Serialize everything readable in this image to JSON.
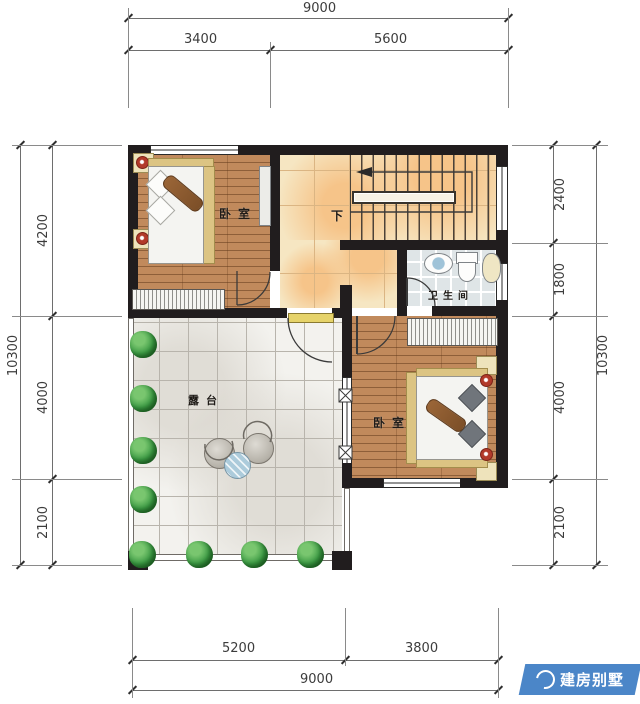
{
  "plan": {
    "rooms": {
      "bedroom1": "卧室",
      "bedroom2": "卧室",
      "bathroom": "卫生间",
      "terrace": "露台",
      "stairs_down": "下"
    },
    "dimensions": {
      "top": {
        "total": "9000",
        "a": "3400",
        "b": "5600"
      },
      "left": {
        "total": "10300",
        "a": "4200",
        "b": "4000",
        "c": "2100"
      },
      "right": {
        "a": "2400",
        "b": "1800",
        "c": "4000",
        "d": "2100",
        "total": "10300"
      },
      "bottom": {
        "a": "5200",
        "b": "3800",
        "total": "9000"
      }
    },
    "colors": {
      "wall": "#211d1e",
      "wood_floor": "#c18a5c",
      "hall_tile": "#f6e6c2",
      "terrace_tile": "#f3f2ee",
      "bath_tile": "#dfe5e7",
      "plant_green": "#3d9b45",
      "lamp_red": "#b23a2a",
      "logo_blue": "#4b86c8"
    }
  },
  "logo": {
    "brand": "建房别墅"
  }
}
